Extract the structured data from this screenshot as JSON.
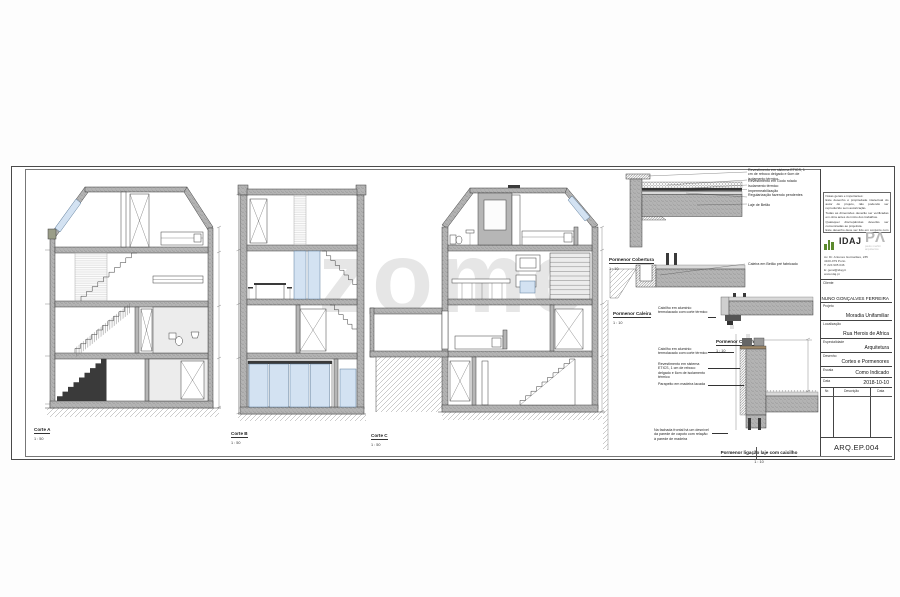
{
  "watermark": "zome",
  "sections": [
    {
      "name": "Corte A",
      "scale": "1 : 50"
    },
    {
      "name": "Corte B",
      "scale": "1 : 50"
    },
    {
      "name": "Corte C",
      "scale": "1 : 50"
    }
  ],
  "details": {
    "cobertura": {
      "name": "Pormenor Cobertura",
      "scale": "1 : 10",
      "annotations": [
        "Revestimento em sistema ETICS, 1 cm de reboco delgado e 6cm de isolamento térmico",
        "Revestimento em Godo rolado",
        "Isolamento térmico",
        "Impermeabilização",
        "Regularização fazendo pendentes",
        "Laje de Betão"
      ]
    },
    "caleira": {
      "name": "Pormenor Caleira",
      "scale": "1 : 10",
      "annotations": [
        "Caleira em Betão pré fabricado"
      ]
    },
    "caixilho": {
      "name": "Pormenor Caixilho",
      "scale": "1 : 10",
      "annotations": [
        "Caixilho em alumínio termolacado com corte térmico"
      ]
    },
    "ligacao": {
      "name": "Pormenor ligação laje com caixilho",
      "scale": "1 : 10",
      "annotations": [
        "Caixilho em alumínio termolacado com corte térmico",
        "Revestimento em sistema ETICS, 1 cm de reboco delgado e 6cm de isolamento térmico",
        "Parapeito em madeira lacada"
      ],
      "note": "Na fachada frontal há um desnível da parede de capoto com relação à parede de madeira"
    }
  },
  "titleblock": {
    "notes": [
      "Notas gerais e importantes:",
      "Este desenho é propriedade intelectual do autor do projeto, não podendo ser reproduzido sem autorização.",
      "Todas as dimensões deverão ser verificadas em obra antes do início dos trabalhos.",
      "Quaisquer discrepâncias deverão ser comunicadas ao projetista.",
      "Este desenho deve ser lido em conjunto com as peças escritas e desenhadas das restantes especialidades."
    ],
    "idaj_logo": "IDAJ",
    "pa_logo": "PΛ",
    "pa_sub1": "paulo merlini",
    "pa_sub2": "arquitectos",
    "address": [
      "Av. Dr. Antunes Guimarães, 235",
      "4100-079 Porto",
      "T: 224 905 046",
      "E: geral@idaj.pt",
      "www.idaj.pt"
    ],
    "fields": [
      {
        "label": "Cliente",
        "value": "NUNO GONÇALVES FERREIRA"
      },
      {
        "label": "Projeto",
        "value": "Moradia Unifamiliar"
      },
      {
        "label": "Localização",
        "value": "Rua Herois de Africa"
      },
      {
        "label": "Especialidade",
        "value": "Arquitetura"
      },
      {
        "label": "Desenho",
        "value": "Cortes e Pormenores"
      },
      {
        "label": "Escala",
        "value": "Como Indicado"
      },
      {
        "label": "Data",
        "value": "2018-10-10"
      }
    ],
    "revisions": {
      "headers": [
        "Nr.",
        "Descrição",
        "Data"
      ]
    },
    "sheet_number": "ARQ.EP.004"
  }
}
